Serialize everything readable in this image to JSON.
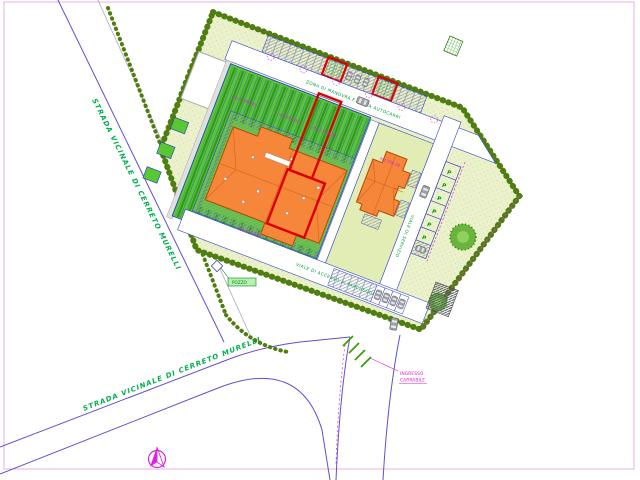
{
  "page": {
    "background": "#ffffff",
    "frame_color": "#e8b0e4"
  },
  "roads": {
    "name_upper": "STRADA VICINALE DI CERRETO MURELLI",
    "name_lower": "STRADA VICINALE DI CERRETO MURELLI",
    "entrance_label_line1": "INGRESSO",
    "entrance_label_line2": "CARRABILE"
  },
  "site": {
    "notes": {
      "top_road": "ZONA DI MANOVRA E SOSTA AUTOCARRI",
      "bottom_road": "VIALE DI ACCESSO AI PARCHEGGI",
      "right_road": "VIALE DI SERVIZIO",
      "well": "POZZO"
    },
    "parking_letter": "P",
    "area_labels": [
      "mq 1.480,00",
      "mq 950,00",
      "mq 1.240,00",
      "mq 760,00",
      "mq 2.150,00"
    ],
    "colors": {
      "site_lawn": "#ebf1cb",
      "field_green": "#58c832",
      "roof_orange": "#f5863a",
      "highlight_red": "#dd0000",
      "hedge_green": "#4f7d10",
      "annotation_magenta": "#e020d0",
      "text_green": "#00a03c",
      "line_blue": "#3344cc"
    }
  },
  "compass": {
    "icon": "north-arrow"
  }
}
